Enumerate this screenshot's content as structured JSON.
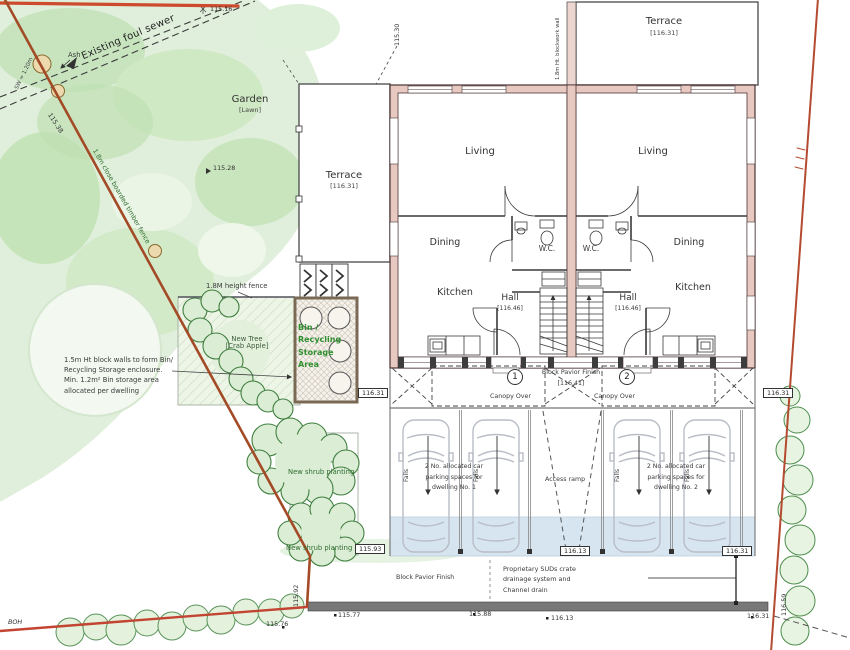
{
  "areas": {
    "garden": {
      "label": "Garden",
      "sub": "[Lawn]"
    },
    "terrace_left": {
      "label": "Terrace",
      "level": "[116.31]"
    },
    "terrace_right": {
      "label": "Terrace",
      "level": "[116.31]"
    },
    "bin_store": {
      "line1": "Bin /",
      "line2": "Recycling",
      "line3": "Storage",
      "line4": "Area"
    }
  },
  "dwellings": [
    {
      "number": "1",
      "living": "Living",
      "dining": "Dining",
      "kitchen": "Kitchen",
      "hall": "Hall",
      "hall_level": "[116.46]",
      "wc": "W.C.",
      "parking1": "2 No. allocated car",
      "parking2": "parking spaces for",
      "parking3": "dwelling No. 1"
    },
    {
      "number": "2",
      "living": "Living",
      "dining": "Dining",
      "kitchen": "Kitchen",
      "hall": "Hall",
      "hall_level": "[116.46]",
      "wc": "W.C.",
      "parking1": "2 No. allocated car",
      "parking2": "parking spaces for",
      "parking3": "dwelling No. 2"
    }
  ],
  "annotations": {
    "existing_foul_sewer": "Existing foul sewer",
    "sewer_size": "SW = 1.20m",
    "ash_tree": "Ash",
    "timber_fence": "1.8m close boarded timber fence",
    "height_fence": "1.8M height fence",
    "blockwork_wall": "1.8m Ht. blockwork wall",
    "bin_wall1": "1.5m Ht block walls to form Bin/",
    "bin_wall2": "Recycling Storage enclosure.",
    "bin_wall3": "Min. 1.2m² Bin storage area",
    "bin_wall4": "allocated per dwelling",
    "new_tree1": "New Tree",
    "new_tree2": "[Crab Apple]",
    "new_shrub_upper": "New shrub planting",
    "new_shrub_lower": "New shrub planting",
    "block_pavior_front": "Block Pavior Finish",
    "block_pavior_front_level": "[116.41]",
    "block_pavior_bottom": "Block Pavior Finish",
    "canopy_over": "Canopy Over",
    "access_ramp": "Access ramp",
    "falls": "Falls",
    "suds1": "Proprietary SUDs crate",
    "suds2": "drainage system and",
    "suds3": "Channel drain",
    "boh": "BOH"
  },
  "levels": {
    "spots": [
      "115.16",
      "115.28",
      "115.38",
      "115.30",
      "115.77",
      "115.88",
      "116.13",
      "116.31",
      "115.76",
      "115.92",
      "116.59"
    ],
    "boxed": [
      "116.31",
      "116.31",
      "115.93",
      "116.13",
      "116.31"
    ]
  },
  "colors": {
    "boundary_red": "#c0392b",
    "wall_pink": "#e7c9c2",
    "planting_green": "#2e6b2e",
    "suds_blue": "#d3e2f0"
  }
}
